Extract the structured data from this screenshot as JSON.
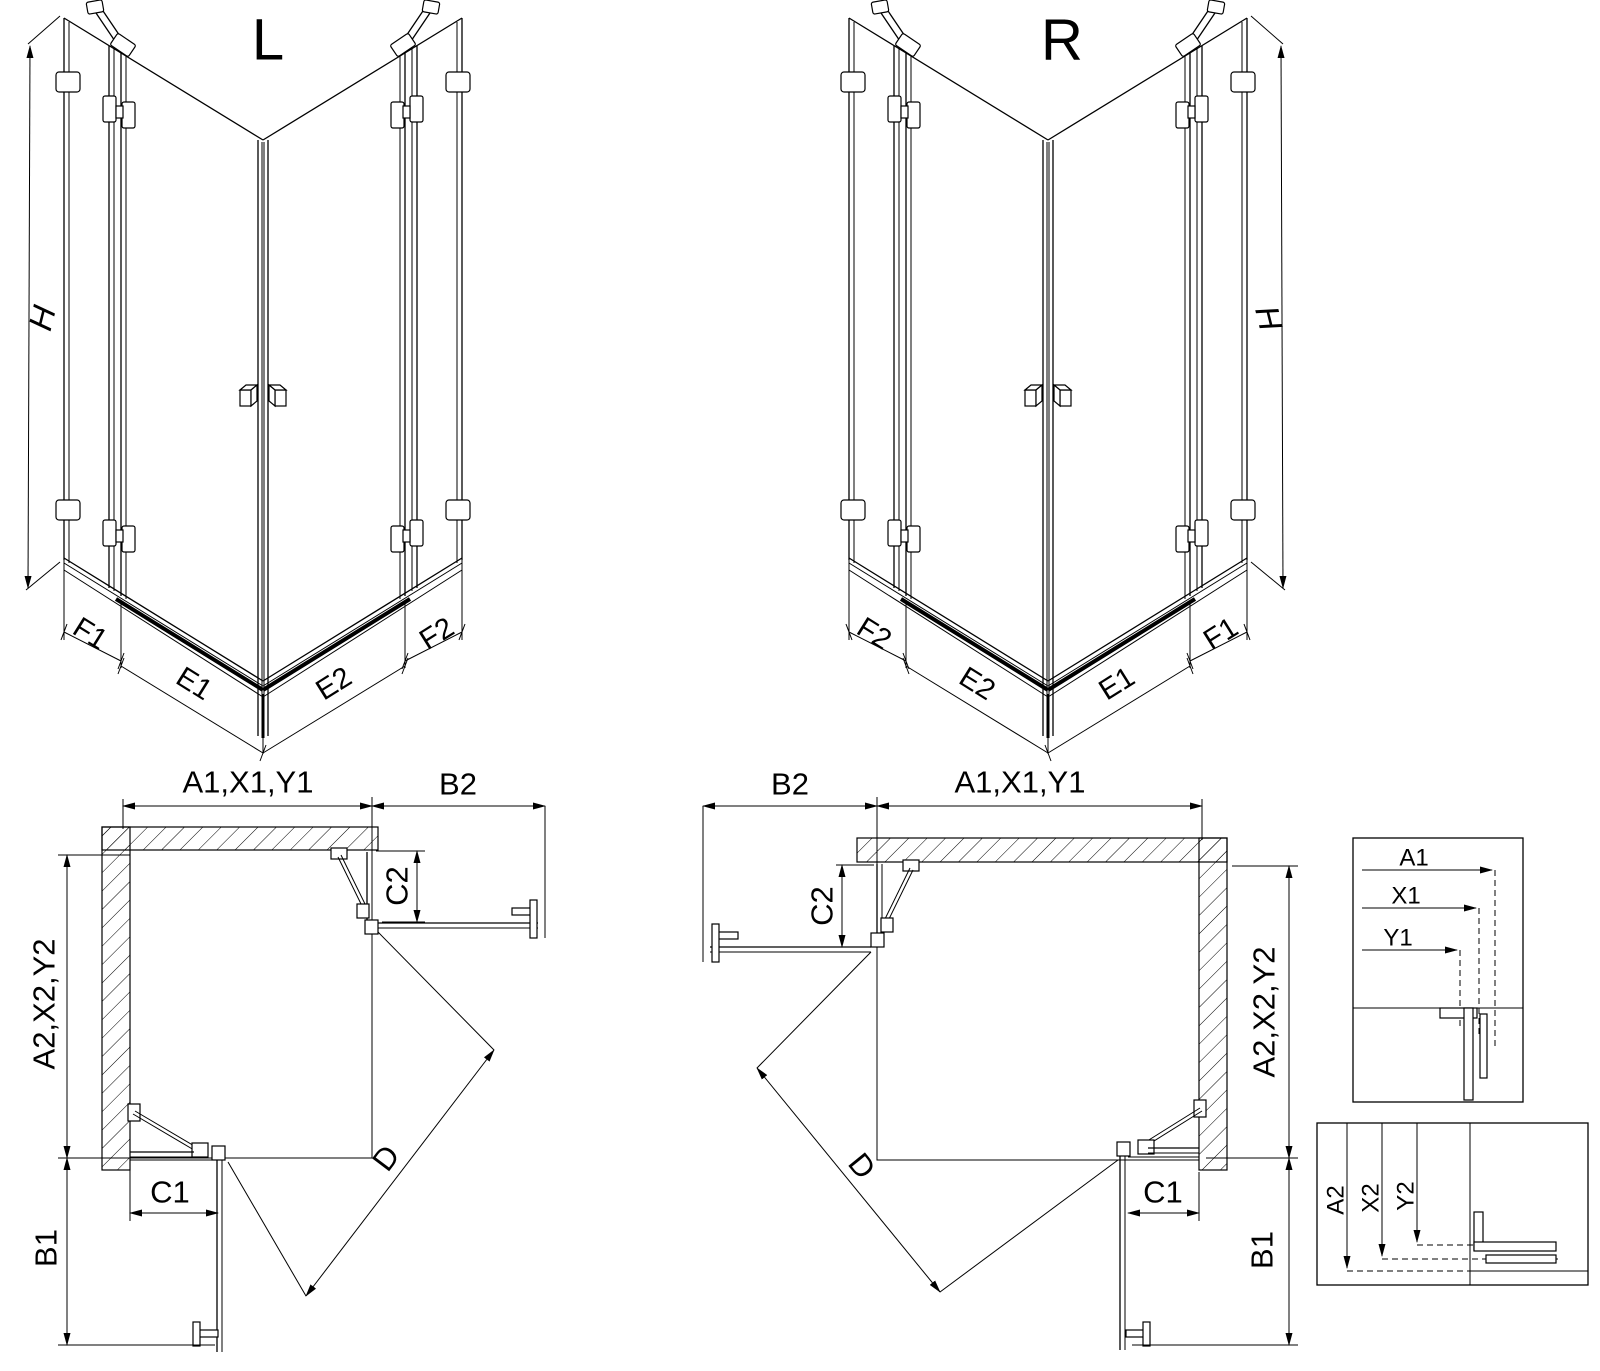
{
  "colors": {
    "line": "#000000",
    "background": "#ffffff"
  },
  "left_3d": {
    "title": "L",
    "height": "H",
    "bottom": [
      "F1",
      "E1",
      "E2",
      "F2"
    ]
  },
  "right_3d": {
    "title": "R",
    "height": "H",
    "bottom": [
      "F2",
      "E2",
      "E1",
      "F1"
    ]
  },
  "left_plan": {
    "top_width": "A1,X1,Y1",
    "top_return": "B2",
    "door_top": "C2",
    "side_depth": "A2,X2,Y2",
    "door_bottom": "C1",
    "bottom_return": "B1",
    "diagonal": "D"
  },
  "right_plan": {
    "top_width": "A1,X1,Y1",
    "top_return": "B2",
    "door_top": "C2",
    "side_depth": "A2,X2,Y2",
    "door_bottom": "C1",
    "bottom_return": "B1",
    "diagonal": "D"
  },
  "detail_top": {
    "rows": [
      "A1",
      "X1",
      "Y1"
    ]
  },
  "detail_bottom": {
    "rows": [
      "A2",
      "X2",
      "Y2"
    ]
  }
}
